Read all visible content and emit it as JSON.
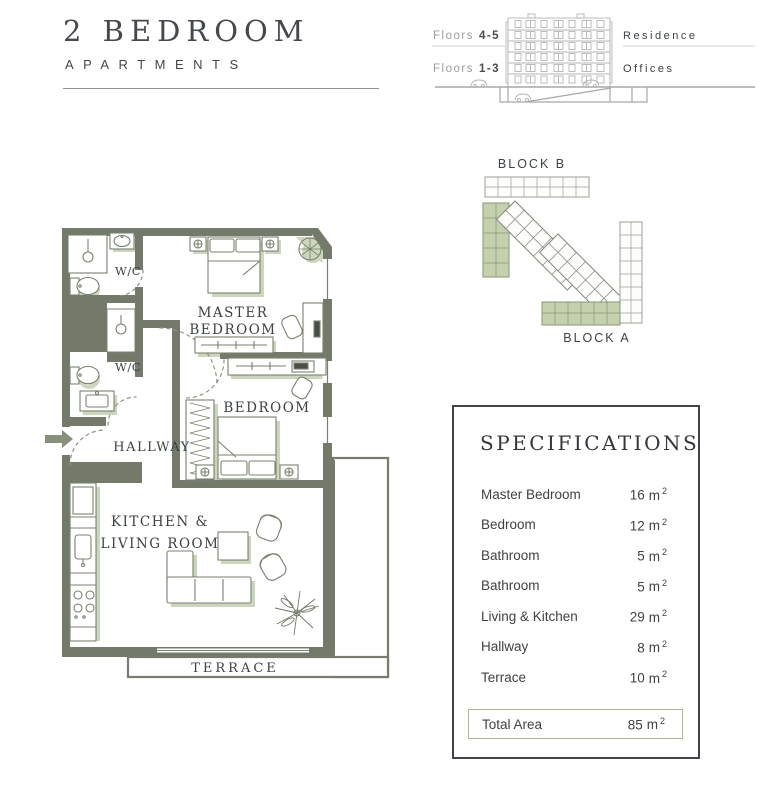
{
  "header": {
    "title": "2 BEDROOM",
    "subtitle": "APARTMENTS"
  },
  "elevation": {
    "floors_top_label": "Floors",
    "floors_top_range": "4-5",
    "use_top": "Residence",
    "floors_bottom_label": "Floors",
    "floors_bottom_range": "1-3",
    "use_bottom": "Offices"
  },
  "site_plan": {
    "block_b": "BLOCK B",
    "block_a": "BLOCK A"
  },
  "floor_plan": {
    "wc_top": "W/C",
    "wc_bottom": "W/C",
    "master_line1": "MASTER",
    "master_line2": "BEDROOM",
    "bedroom": "BEDROOM",
    "hallway": "HALLWAY",
    "kitchen_line1": "KITCHEN &",
    "kitchen_line2": "LIVING ROOM",
    "terrace": "TERRACE"
  },
  "specifications": {
    "title": "SPECIFICATIONS",
    "unit": "m",
    "sup": "2",
    "rows": [
      {
        "label": "Master Bedroom",
        "area": "16"
      },
      {
        "label": "Bedroom",
        "area": "12"
      },
      {
        "label": "Bathroom",
        "area": "5"
      },
      {
        "label": "Bathroom",
        "area": "5"
      },
      {
        "label": "Living & Kitchen",
        "area": "29"
      },
      {
        "label": "Hallway",
        "area": "8"
      },
      {
        "label": "Terrace",
        "area": "10"
      }
    ],
    "total": {
      "label": "Total Area",
      "area": "85"
    }
  },
  "colors": {
    "wall": "#737a69",
    "sage": "#ccd6ba",
    "site_green": "#c5d1ad",
    "total_border": "#a9bc8b",
    "text_dark": "#3c4145",
    "line_gray": "#b5b5b5"
  }
}
